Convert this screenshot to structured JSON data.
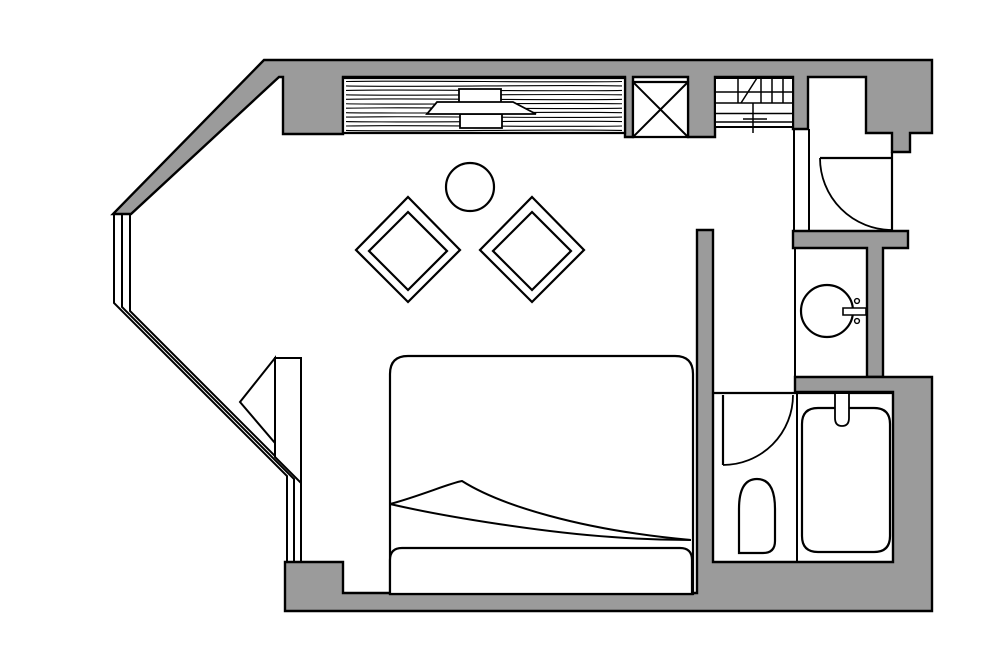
{
  "canvas": {
    "width": 1000,
    "height": 653,
    "background": "#ffffff"
  },
  "palette": {
    "wall_fill": "#9b9b9b",
    "line": "#000000",
    "floor": "#ffffff"
  },
  "floorplan": {
    "kind": "hotel-room-floor-plan",
    "shapes": [
      {
        "name": "wall-top-and-diagonal",
        "type": "path",
        "fill": "wall",
        "sw": 2.4,
        "d": "M264,60 L932,60 L932,133 L910,133 L910,152 L892,152 L892,133 L866,133 L866,77 L808,77 L808,129 L793,129 L793,77 L715,77 L715,137 L688,137 L688,77 L633,77 L633,137 L625,137 L625,77 L343,77 L343,134 L283,134 L283,77 L279,77 L131,214 L113,214 Z"
      },
      {
        "name": "wall-entry-band-and-sink-wall",
        "type": "path",
        "fill": "wall",
        "sw": 2.4,
        "d": "M793,231 L908,231 L908,248 L883,248 L883,377 L867,377 L867,248 L793,248 Z"
      },
      {
        "name": "wall-right-and-bottom",
        "type": "path",
        "fill": "wall",
        "sw": 2.4,
        "d": "M697,230 L713,230 L713,562 L893,562 L893,392 L795,392 L795,377 L932,377 L932,611 L285,611 L285,562 L343,562 L343,593 L697,593 Z"
      },
      {
        "name": "entry-partition-line-west",
        "type": "line",
        "x1": 794,
        "y1": 129,
        "x2": 794,
        "y2": 231,
        "sw": 2
      },
      {
        "name": "entry-partition-line-east",
        "type": "line",
        "x1": 809,
        "y1": 129,
        "x2": 809,
        "y2": 231,
        "sw": 2
      },
      {
        "name": "bay-window-line-outer",
        "type": "path",
        "fill": "none",
        "sw": 2,
        "d": "M114,215 V303 L287,476 V562"
      },
      {
        "name": "bay-window-line-middle",
        "type": "path",
        "fill": "none",
        "sw": 2,
        "d": "M122,215 V307 L294,479 V562"
      },
      {
        "name": "bay-window-line-inner",
        "type": "path",
        "fill": "none",
        "sw": 2,
        "d": "M130,215 V311 L301,482 V562"
      },
      {
        "name": "window-bench-panel",
        "type": "path",
        "fill": "white",
        "sw": 2,
        "d": "M275,358 L301,358 L301,483 L275,457 Z"
      },
      {
        "name": "window-bench-triangle",
        "type": "path",
        "fill": "white",
        "sw": 2,
        "d": "M275,358 L240,402 L275,443 Z"
      },
      {
        "name": "wardrobe-body",
        "type": "path",
        "fill": "white",
        "sw": 2.2,
        "d": "M343,78 H625 V133 H343 Z"
      },
      {
        "name": "wardrobe-wood-grain",
        "type": "grain",
        "x1": 346,
        "x2": 622,
        "y": 81.5,
        "dy": 4.45,
        "count": 12,
        "amp": 1.4,
        "sw": 1.1
      },
      {
        "name": "wardrobe-handle-top",
        "type": "path",
        "fill": "white",
        "sw": 1.8,
        "d": "M459,89 H501 V103 H459 Z"
      },
      {
        "name": "wardrobe-handle-bottom",
        "type": "path",
        "fill": "white",
        "sw": 1.8,
        "d": "M460,114 H502 V128 H460 Z"
      },
      {
        "name": "wardrobe-handle-middle",
        "type": "path",
        "fill": "white",
        "sw": 1.8,
        "d": "M427,114 L437,102 L513,102 L536,114 Z"
      },
      {
        "name": "shaft-box",
        "type": "path",
        "fill": "white",
        "sw": 2.2,
        "d": "M633,82 H688 V137 H633 Z"
      },
      {
        "name": "shaft-diagonal-1",
        "type": "line",
        "x1": 633,
        "y1": 82,
        "x2": 688,
        "y2": 137,
        "sw": 2
      },
      {
        "name": "shaft-diagonal-2",
        "type": "line",
        "x1": 688,
        "y1": 82,
        "x2": 633,
        "y2": 137,
        "sw": 2
      },
      {
        "name": "shelf-unit-frame",
        "type": "path",
        "fill": "white",
        "sw": 2,
        "d": "M715,78 H793 V127 H715 Z"
      },
      {
        "name": "shelf-line-1",
        "type": "line",
        "x1": 715,
        "y1": 92,
        "x2": 793,
        "y2": 92,
        "sw": 1.5
      },
      {
        "name": "shelf-line-2",
        "type": "line",
        "x1": 715,
        "y1": 103,
        "x2": 793,
        "y2": 103,
        "sw": 1.5
      },
      {
        "name": "shelf-line-3",
        "type": "line",
        "x1": 715,
        "y1": 113.5,
        "x2": 793,
        "y2": 113.5,
        "sw": 1.5
      },
      {
        "name": "shelf-line-4",
        "type": "line",
        "x1": 715,
        "y1": 122,
        "x2": 793,
        "y2": 122,
        "sw": 1.5
      },
      {
        "name": "shelf-divider-1",
        "type": "line",
        "x1": 738,
        "y1": 78,
        "x2": 738,
        "y2": 103,
        "sw": 1.5
      },
      {
        "name": "shelf-divider-2",
        "type": "line",
        "x1": 761,
        "y1": 78,
        "x2": 761,
        "y2": 103,
        "sw": 1.5
      },
      {
        "name": "shelf-divider-3",
        "type": "line",
        "x1": 772,
        "y1": 78,
        "x2": 772,
        "y2": 103,
        "sw": 1.5
      },
      {
        "name": "shelf-divider-4",
        "type": "line",
        "x1": 783,
        "y1": 78,
        "x2": 783,
        "y2": 103,
        "sw": 1.5
      },
      {
        "name": "shelf-diagonal-mark",
        "type": "line",
        "x1": 741,
        "y1": 103,
        "x2": 757,
        "y2": 78,
        "sw": 1.5
      },
      {
        "name": "shelf-stem-mark",
        "type": "line",
        "x1": 753,
        "y1": 103,
        "x2": 753,
        "y2": 133,
        "sw": 1.5
      },
      {
        "name": "shelf-tick-mark",
        "type": "line",
        "x1": 743,
        "y1": 119,
        "x2": 767,
        "y2": 119,
        "sw": 1.5
      },
      {
        "name": "entry-door-leaf",
        "type": "line",
        "x1": 820,
        "y1": 158,
        "x2": 892,
        "y2": 158,
        "sw": 2.2
      },
      {
        "name": "entry-door-jamb",
        "type": "line",
        "x1": 892,
        "y1": 152,
        "x2": 892,
        "y2": 231,
        "sw": 2.2
      },
      {
        "name": "entry-door-swing-arc",
        "type": "path",
        "fill": "none",
        "sw": 1.8,
        "d": "M820,158 A72,72 0 0 0 892,230"
      },
      {
        "name": "sink-alcove-edge-line",
        "type": "line",
        "x1": 795,
        "y1": 248,
        "x2": 795,
        "y2": 377,
        "sw": 2
      },
      {
        "name": "washbasin-bowl",
        "type": "circle",
        "cx": 827,
        "cy": 311,
        "r": 26,
        "fill": "white",
        "sw": 2.2
      },
      {
        "name": "washbasin-faucet-bar",
        "type": "path",
        "fill": "white",
        "sw": 1.6,
        "d": "M843,308 H866 V315 H843 Z"
      },
      {
        "name": "washbasin-tap-dot-top",
        "type": "circle",
        "cx": 857,
        "cy": 301,
        "r": 2.4,
        "fill": "white",
        "sw": 1.4
      },
      {
        "name": "washbasin-tap-dot-bottom",
        "type": "circle",
        "cx": 857,
        "cy": 321,
        "r": 2.4,
        "fill": "white",
        "sw": 1.4
      },
      {
        "name": "bathroom-threshold-line",
        "type": "line",
        "x1": 713,
        "y1": 393,
        "x2": 893,
        "y2": 393,
        "sw": 2.2
      },
      {
        "name": "bathroom-divider-line",
        "type": "line",
        "x1": 797,
        "y1": 393,
        "x2": 797,
        "y2": 562,
        "sw": 2
      },
      {
        "name": "bathroom-door-leaf",
        "type": "line",
        "x1": 723,
        "y1": 395,
        "x2": 723,
        "y2": 465,
        "sw": 2.2
      },
      {
        "name": "bathroom-door-swing-arc",
        "type": "path",
        "fill": "none",
        "sw": 1.8,
        "d": "M723,465 A70,70 0 0 0 793,395"
      },
      {
        "name": "toilet",
        "type": "path",
        "fill": "white",
        "sw": 2.2,
        "d": "M739,553 V509 Q739,479 757,479 Q775,479 775,509 V541 Q775,553 763,553 Z"
      },
      {
        "name": "bathtub",
        "type": "path",
        "fill": "white",
        "sw": 2.2,
        "d": "M818,408 H874 Q890,408 890,424 V536 Q890,552 874,552 H818 Q802,552 802,536 V424 Q802,408 818,408 Z"
      },
      {
        "name": "bathtub-faucet",
        "type": "path",
        "fill": "white",
        "sw": 1.8,
        "d": "M835,394 V418 Q835,426 842,426 Q849,426 849,418 V394"
      },
      {
        "name": "bed-mattress",
        "type": "path",
        "fill": "white",
        "sw": 2.2,
        "d": "M408,356 H675 Q693,356 693,374 V594 H390 V374 Q390,356 408,356 Z"
      },
      {
        "name": "bed-sheet-fold-upper",
        "type": "path",
        "fill": "none",
        "sw": 2,
        "d": "M390,504 C420,496 450,483 462,481 C500,505 580,530 691,540"
      },
      {
        "name": "bed-sheet-fold-lower",
        "type": "path",
        "fill": "none",
        "sw": 2,
        "d": "M390,504 C450,518 550,533 612,537 C652,540 676,540 691,540"
      },
      {
        "name": "bed-footboard",
        "type": "path",
        "fill": "white",
        "sw": 2.2,
        "d": "M402,548 H680 Q692,548 692,560 V594 H390 V560 Q390,548 402,548 Z"
      },
      {
        "name": "round-table",
        "type": "circle",
        "cx": 470,
        "cy": 187,
        "r": 24,
        "fill": "white",
        "sw": 2.2
      },
      {
        "name": "chair-left-outer",
        "type": "path",
        "fill": "white",
        "sw": 2.2,
        "d": "M408,197 L460,250 L408,302 L356,250 Z"
      },
      {
        "name": "chair-left-inner",
        "type": "path",
        "fill": "white",
        "sw": 2.2,
        "d": "M408,212 L447,251 L408,290 L369,251 Z"
      },
      {
        "name": "chair-right-outer",
        "type": "path",
        "fill": "white",
        "sw": 2.2,
        "d": "M532,197 L584,250 L532,302 L480,250 Z"
      },
      {
        "name": "chair-right-inner",
        "type": "path",
        "fill": "white",
        "sw": 2.2,
        "d": "M532,212 L571,251 L532,290 L493,251 Z"
      }
    ]
  }
}
